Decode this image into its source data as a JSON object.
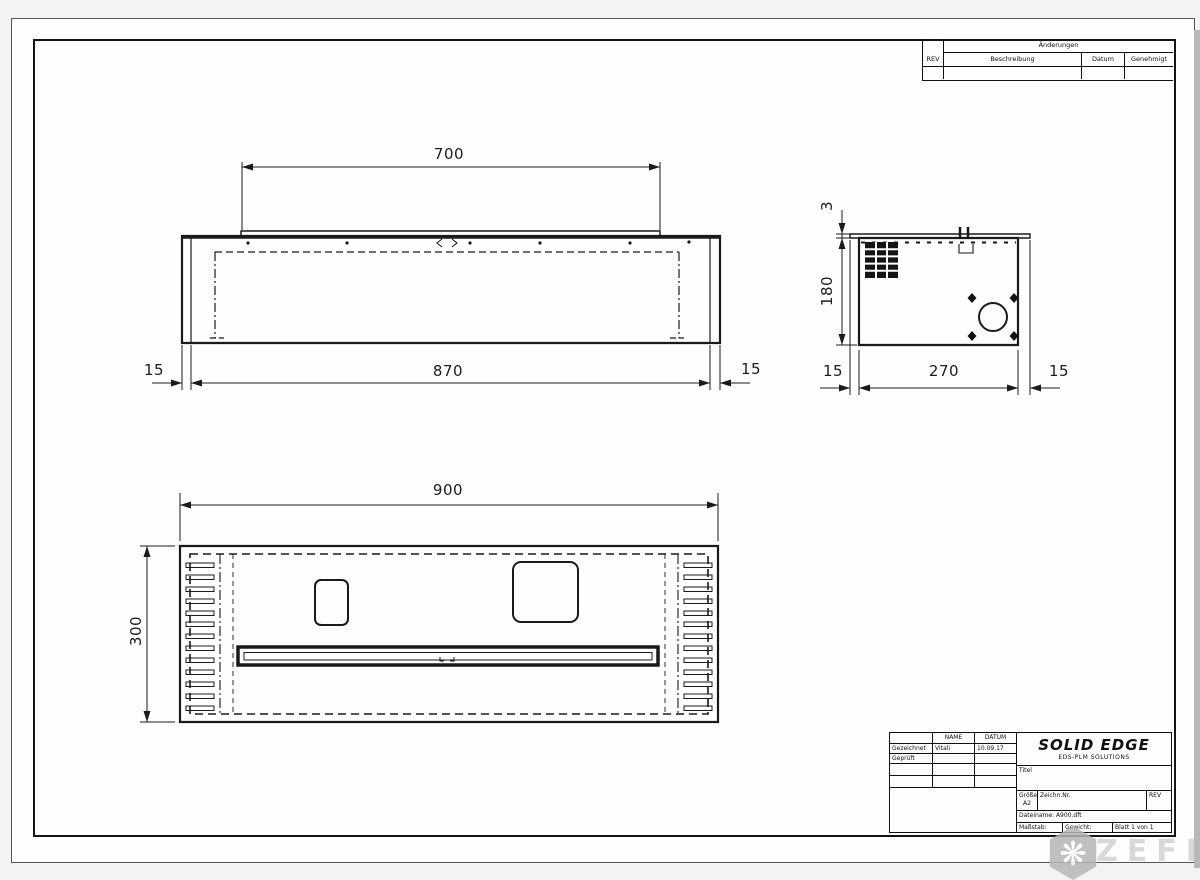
{
  "revisions_table": {
    "title": "Änderungen",
    "columns": [
      "REV",
      "Beschreibung",
      "Datum",
      "Genehmigt"
    ]
  },
  "title_block": {
    "name_col": "NAME",
    "datum_col": "DATUM",
    "row1_label": "Gezeichnet",
    "row1_name": "Vitali",
    "row1_date": "10.09.17",
    "row2_label": "Geprüft",
    "logo_title": "SOLID EDGE",
    "logo_subtitle": "EDS-PLM SOLUTIONS",
    "titel_label": "Titel",
    "groesse_label": "Größe",
    "groesse_value": "A2",
    "zeichn_label": "Zeichn.Nr.",
    "rev_label": "REV",
    "dateiname": "Dateiname: A900.dft",
    "massstab_label": "Maßstab:",
    "gewicht_label": "Gewicht:",
    "blatt_label": "Blatt 1 von 1"
  },
  "dimensions": {
    "front": {
      "top_width": "700",
      "bottom_width": "870",
      "left_wall": "15",
      "right_wall": "15"
    },
    "side": {
      "flange_thickness": "3",
      "height": "180",
      "left_flange": "15",
      "depth": "270",
      "right_flange": "15"
    },
    "plan": {
      "overall_width": "900",
      "overall_depth": "300"
    }
  },
  "watermark": {
    "text": "ZEFIRE"
  }
}
